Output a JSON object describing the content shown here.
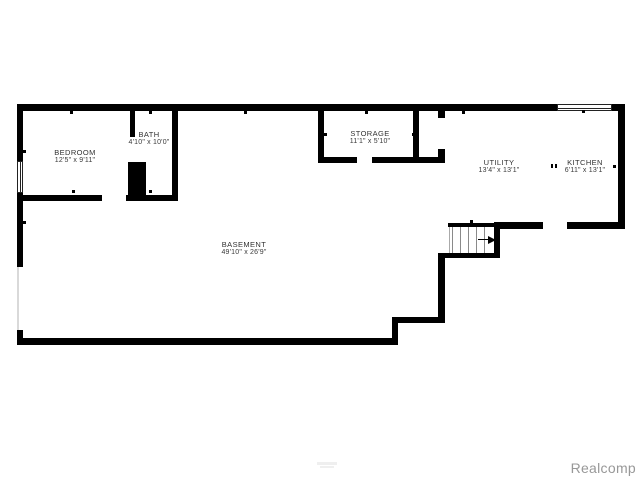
{
  "canvas": {
    "background": "#ffffff",
    "wall_color": "#000000"
  },
  "rooms": {
    "bedroom": {
      "name": "BEDROOM",
      "dims": "12'5\" x 9'11\""
    },
    "bath": {
      "name": "BATH",
      "dims": "4'10\" x 10'0\""
    },
    "storage": {
      "name": "STORAGE",
      "dims": "11'1\" x 5'10\""
    },
    "utility": {
      "name": "UTILITY",
      "dims": "13'4\" x 13'1\""
    },
    "kitchen": {
      "name": "KITCHEN",
      "dims": "6'11\" x 13'1\""
    },
    "basement": {
      "name": "BASEMENT",
      "dims": "49'10\" x 26'9\""
    }
  },
  "watermark": {
    "text": "Realcomp",
    "color": "#989898"
  }
}
